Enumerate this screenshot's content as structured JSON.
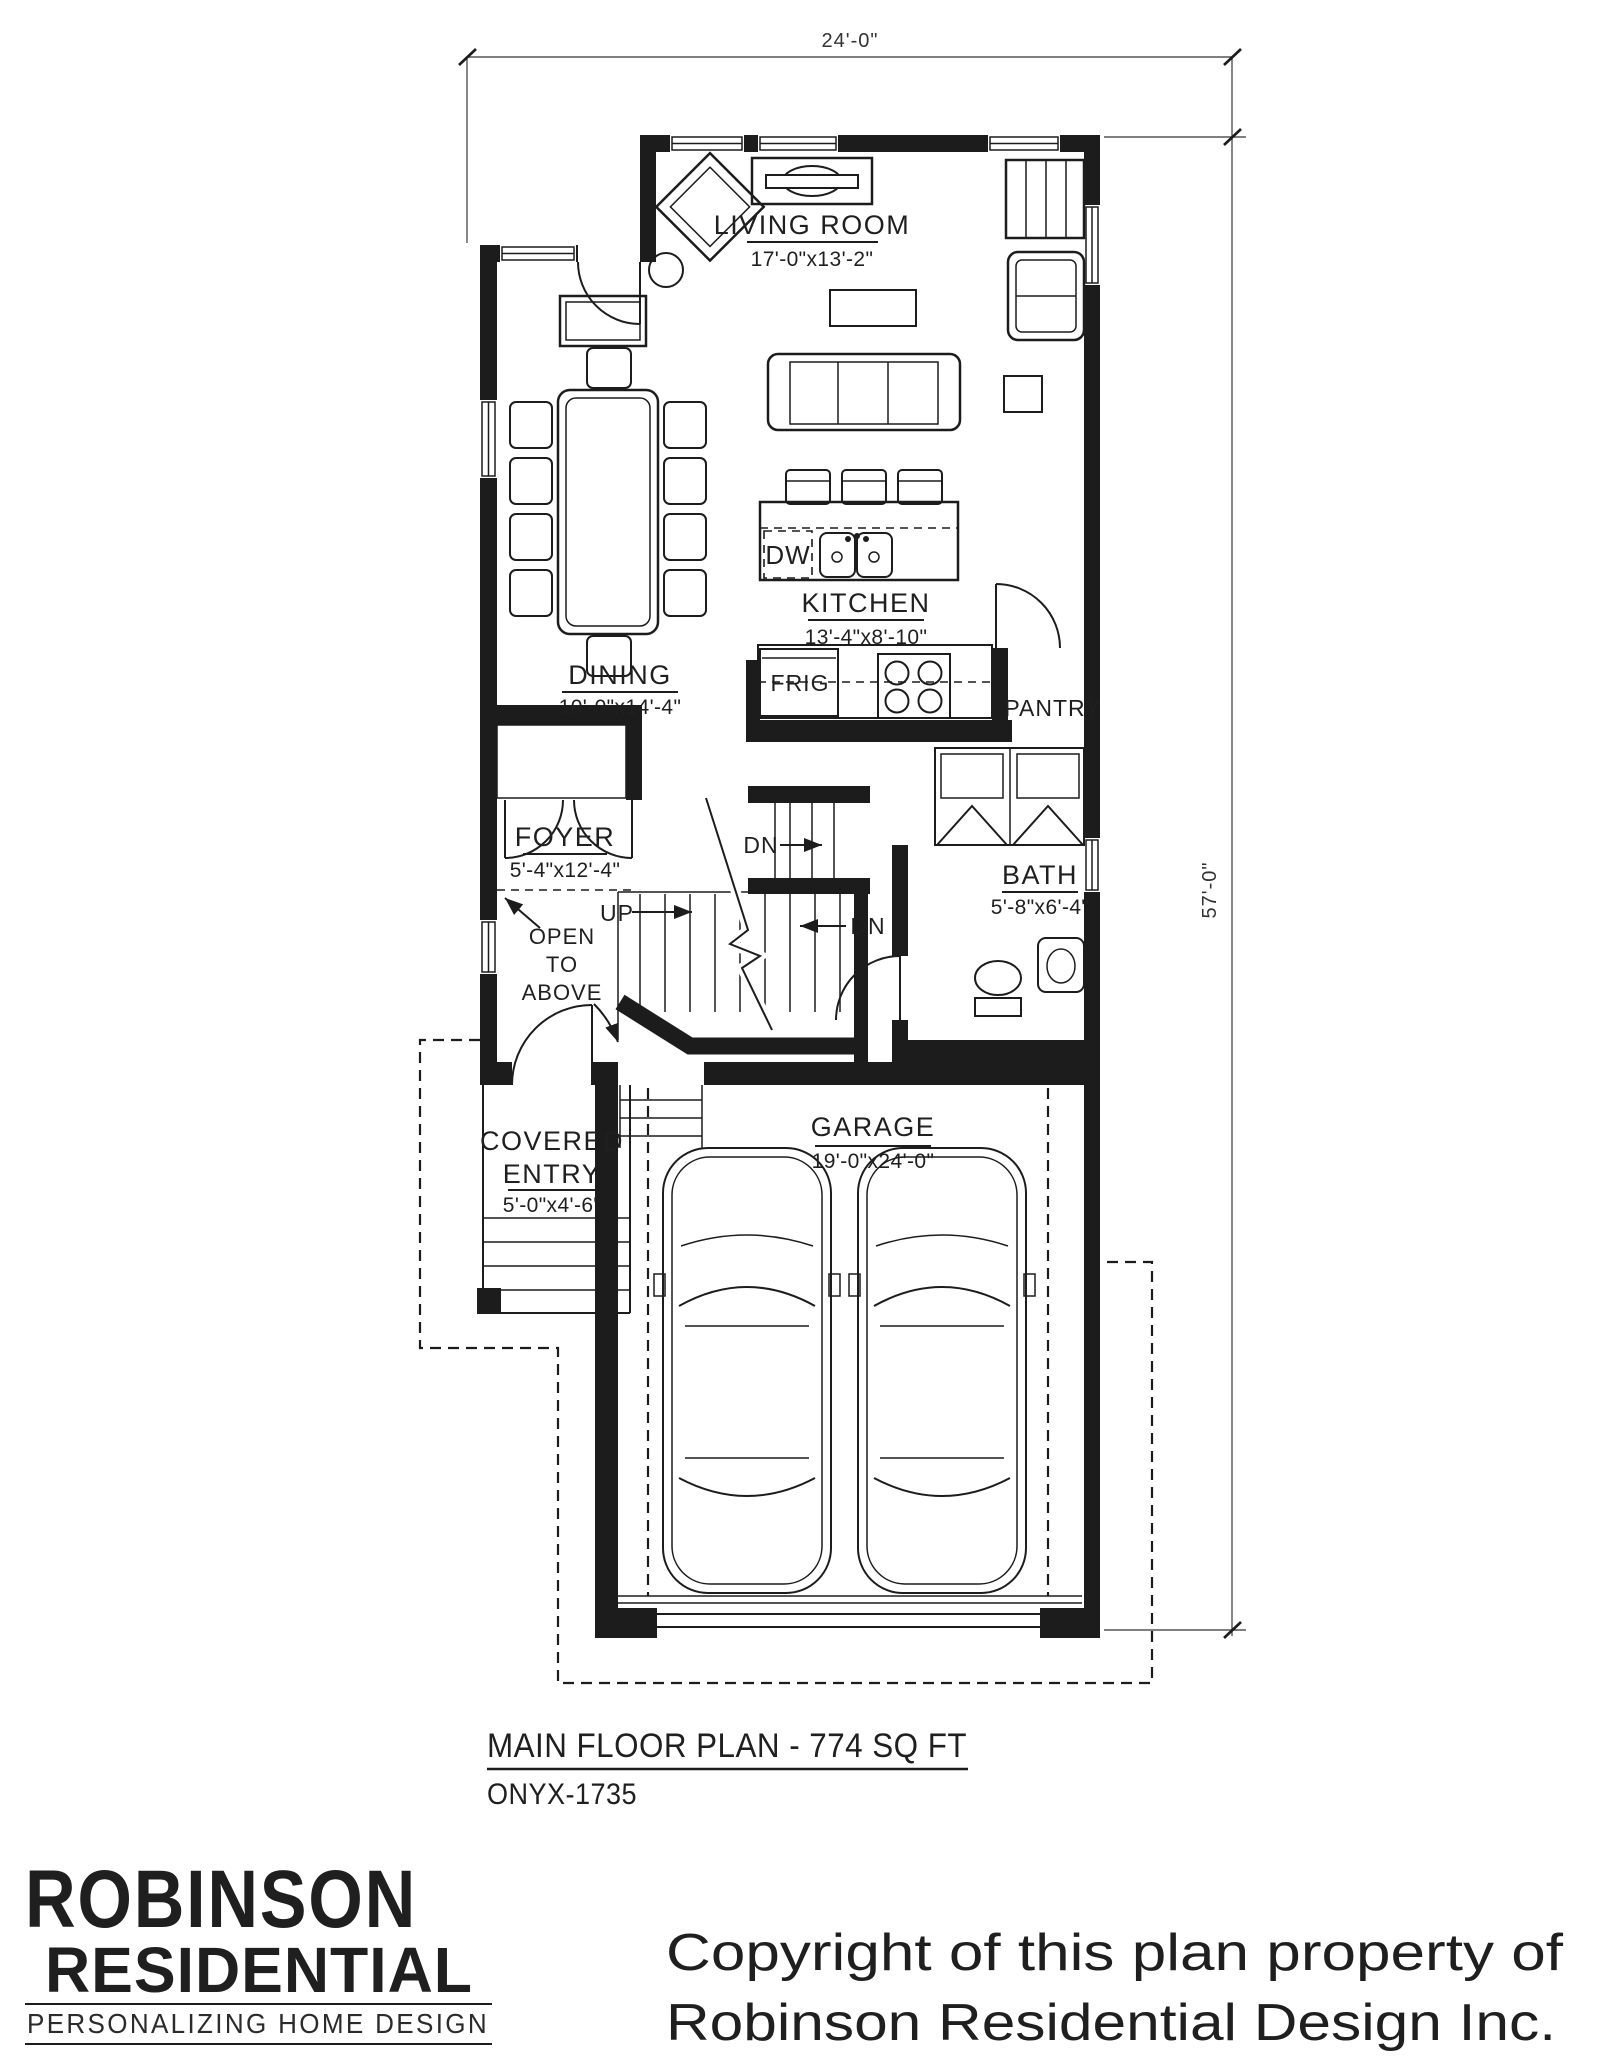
{
  "colors": {
    "ink": "#1c1c1c",
    "red": "#e42320",
    "background": "#ffffff"
  },
  "dimensions": {
    "width": "24'-0\"",
    "height": "57'-0\""
  },
  "rooms": {
    "living": {
      "name": "LIVING ROOM",
      "size": "17'-0\"x13'-2\""
    },
    "kitchen": {
      "name": "KITCHEN",
      "size": "13'-4\"x8'-10\""
    },
    "dining": {
      "name": "DINING",
      "size": "10'-0\"x14'-4\""
    },
    "foyer": {
      "name": "FOYER",
      "size": "5'-4\"x12'-4\""
    },
    "bath": {
      "name": "BATH",
      "size": "5'-8\"x6'-4\""
    },
    "garage": {
      "name": "GARAGE",
      "size": "19'-0\"x24'-0\""
    },
    "covered_entry": {
      "name_line1": "COVERED",
      "name_line2": "ENTRY",
      "size": "5'-0\"x4'-6\""
    },
    "pantry": {
      "name": "PANTRY"
    }
  },
  "fixtures": {
    "fridge": "FRIG",
    "dishwasher": "DW"
  },
  "stairs": {
    "up": "UP",
    "down_upper": "DN",
    "down_lower": "DN",
    "open_above_line1": "OPEN",
    "open_above_line2": "TO",
    "open_above_line3": "ABOVE"
  },
  "title_block": {
    "plan_title": "MAIN FLOOR PLAN - 774 SQ FT",
    "plan_code": "ONYX-1735"
  },
  "brand": {
    "name_line1": "ROBINSON",
    "name_line2": "RESIDENTIAL",
    "tagline": "PERSONALIZING HOME DESIGN"
  },
  "copyright": {
    "line1": "Copyright of this plan property of",
    "line2": "Robinson Residential Design Inc."
  }
}
